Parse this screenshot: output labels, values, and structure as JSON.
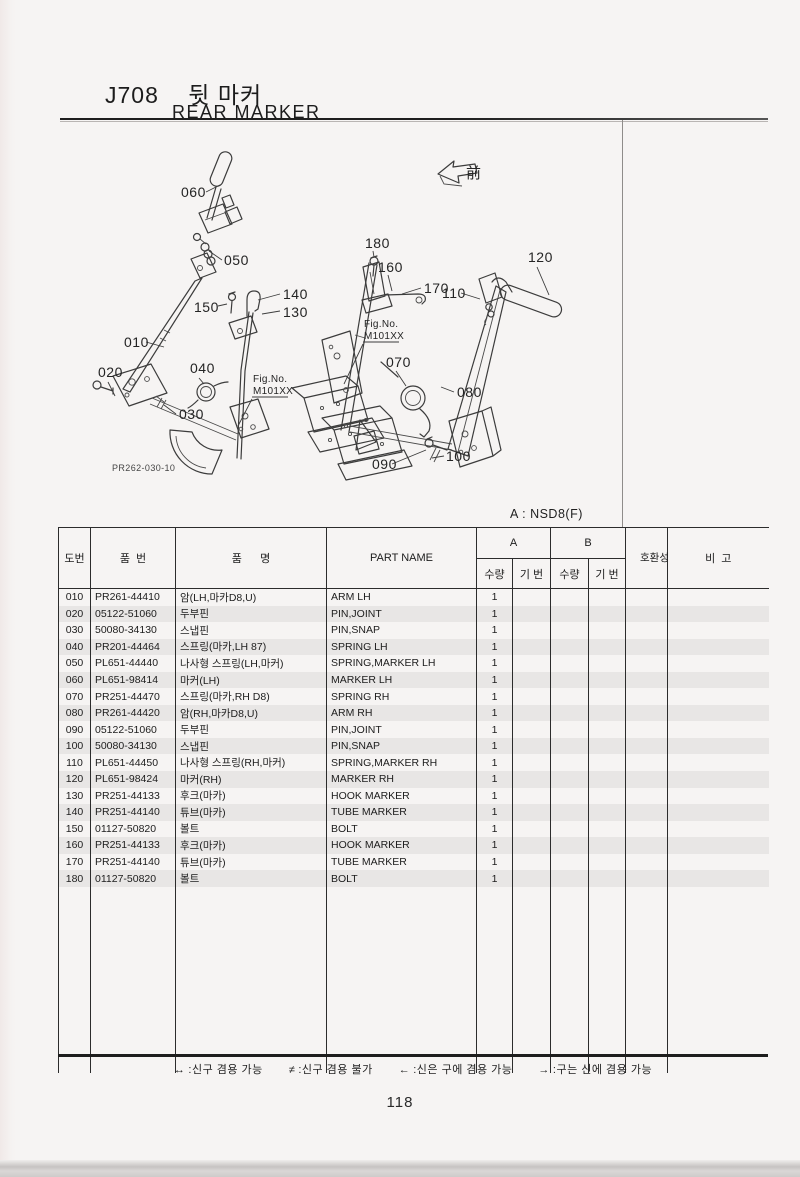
{
  "page": {
    "code": "J708",
    "title_ko": "뒷 마커",
    "title_en": "REAR MARKER",
    "variant_note": "A : NSD8(F)",
    "page_number": "118"
  },
  "diagram": {
    "front_label": "前",
    "drawing_number": "PR262-030-10",
    "fig_refs": [
      {
        "line1": "Fig.No.",
        "line2": "M101XX"
      },
      {
        "line1": "Fig.No.",
        "line2": "M101XX"
      }
    ],
    "labels": [
      "060",
      "050",
      "150",
      "140",
      "130",
      "010",
      "020",
      "040",
      "030",
      "180",
      "160",
      "170",
      "110",
      "120",
      "070",
      "080",
      "090",
      "100"
    ]
  },
  "table": {
    "headers": {
      "ref": "도번",
      "part_no": "품  번",
      "name_ko": "품      명",
      "part_name": "PART NAME",
      "a": "A",
      "b": "B",
      "qty": "수량",
      "serial": "기 번",
      "compat": "호환성",
      "remarks": "비  고"
    },
    "rows": [
      {
        "ref": "010",
        "part_no": "PR261-44410",
        "name_ko": "암(LH,마카D8,U)",
        "part_name": "ARM LH",
        "qty_a": "1",
        "ser_a": "",
        "qty_b": "",
        "ser_b": "",
        "compat": "",
        "remarks": ""
      },
      {
        "ref": "020",
        "part_no": "05122-51060",
        "name_ko": "두부핀",
        "part_name": "PIN,JOINT",
        "qty_a": "1",
        "ser_a": "",
        "qty_b": "",
        "ser_b": "",
        "compat": "",
        "remarks": ""
      },
      {
        "ref": "030",
        "part_no": "50080-34130",
        "name_ko": "스냅핀",
        "part_name": "PIN,SNAP",
        "qty_a": "1",
        "ser_a": "",
        "qty_b": "",
        "ser_b": "",
        "compat": "",
        "remarks": ""
      },
      {
        "ref": "040",
        "part_no": "PR201-44464",
        "name_ko": "스프링(마카,LH 87)",
        "part_name": "SPRING LH",
        "qty_a": "1",
        "ser_a": "",
        "qty_b": "",
        "ser_b": "",
        "compat": "",
        "remarks": ""
      },
      {
        "ref": "050",
        "part_no": "PL651-44440",
        "name_ko": "나사형 스프링(LH,마커)",
        "part_name": "SPRING,MARKER LH",
        "qty_a": "1",
        "ser_a": "",
        "qty_b": "",
        "ser_b": "",
        "compat": "",
        "remarks": ""
      },
      {
        "ref": "060",
        "part_no": "PL651-98414",
        "name_ko": "마커(LH)",
        "part_name": "MARKER LH",
        "qty_a": "1",
        "ser_a": "",
        "qty_b": "",
        "ser_b": "",
        "compat": "",
        "remarks": ""
      },
      {
        "ref": "070",
        "part_no": "PR251-44470",
        "name_ko": "스프링(마카,RH D8)",
        "part_name": "SPRING RH",
        "qty_a": "1",
        "ser_a": "",
        "qty_b": "",
        "ser_b": "",
        "compat": "",
        "remarks": ""
      },
      {
        "ref": "080",
        "part_no": "PR261-44420",
        "name_ko": "암(RH,마카D8,U)",
        "part_name": "ARM RH",
        "qty_a": "1",
        "ser_a": "",
        "qty_b": "",
        "ser_b": "",
        "compat": "",
        "remarks": ""
      },
      {
        "ref": "090",
        "part_no": "05122-51060",
        "name_ko": "두부핀",
        "part_name": "PIN,JOINT",
        "qty_a": "1",
        "ser_a": "",
        "qty_b": "",
        "ser_b": "",
        "compat": "",
        "remarks": ""
      },
      {
        "ref": "100",
        "part_no": "50080-34130",
        "name_ko": "스냅핀",
        "part_name": "PIN,SNAP",
        "qty_a": "1",
        "ser_a": "",
        "qty_b": "",
        "ser_b": "",
        "compat": "",
        "remarks": ""
      },
      {
        "ref": "110",
        "part_no": "PL651-44450",
        "name_ko": "나사형 스프링(RH,마커)",
        "part_name": "SPRING,MARKER RH",
        "qty_a": "1",
        "ser_a": "",
        "qty_b": "",
        "ser_b": "",
        "compat": "",
        "remarks": ""
      },
      {
        "ref": "120",
        "part_no": "PL651-98424",
        "name_ko": "마커(RH)",
        "part_name": "MARKER RH",
        "qty_a": "1",
        "ser_a": "",
        "qty_b": "",
        "ser_b": "",
        "compat": "",
        "remarks": ""
      },
      {
        "ref": "130",
        "part_no": "PR251-44133",
        "name_ko": "후크(마카)",
        "part_name": "HOOK MARKER",
        "qty_a": "1",
        "ser_a": "",
        "qty_b": "",
        "ser_b": "",
        "compat": "",
        "remarks": ""
      },
      {
        "ref": "140",
        "part_no": "PR251-44140",
        "name_ko": "튜브(마카)",
        "part_name": "TUBE MARKER",
        "qty_a": "1",
        "ser_a": "",
        "qty_b": "",
        "ser_b": "",
        "compat": "",
        "remarks": ""
      },
      {
        "ref": "150",
        "part_no": "01127-50820",
        "name_ko": "볼트",
        "part_name": "BOLT",
        "qty_a": "1",
        "ser_a": "",
        "qty_b": "",
        "ser_b": "",
        "compat": "",
        "remarks": ""
      },
      {
        "ref": "160",
        "part_no": "PR251-44133",
        "name_ko": "후크(마카)",
        "part_name": "HOOK MARKER",
        "qty_a": "1",
        "ser_a": "",
        "qty_b": "",
        "ser_b": "",
        "compat": "",
        "remarks": ""
      },
      {
        "ref": "170",
        "part_no": "PR251-44140",
        "name_ko": "튜브(마카)",
        "part_name": "TUBE MARKER",
        "qty_a": "1",
        "ser_a": "",
        "qty_b": "",
        "ser_b": "",
        "compat": "",
        "remarks": ""
      },
      {
        "ref": "180",
        "part_no": "01127-50820",
        "name_ko": "볼트",
        "part_name": "BOLT",
        "qty_a": "1",
        "ser_a": "",
        "qty_b": "",
        "ser_b": "",
        "compat": "",
        "remarks": ""
      }
    ]
  },
  "legend": {
    "items": [
      {
        "symbol": "↔",
        "label": ":신구 겸용 가능"
      },
      {
        "symbol": "≠",
        "label": ":신구 겸용 불가"
      },
      {
        "symbol": "←",
        "label": ":신은 구에 겸용 가능"
      },
      {
        "symbol": "→",
        "label": ":구는 신에 겸용 가능"
      }
    ]
  }
}
